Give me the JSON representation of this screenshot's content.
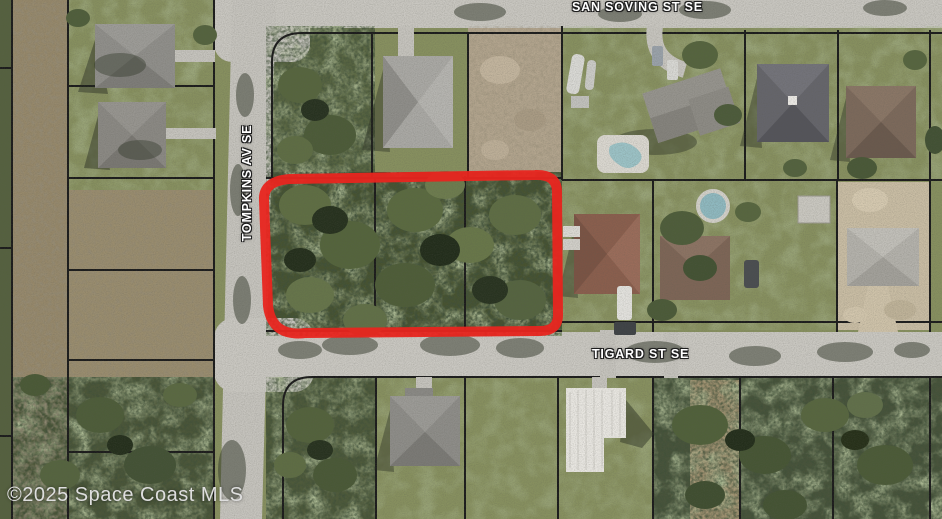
{
  "map": {
    "type": "aerial-satellite-parcel-map",
    "streets": [
      {
        "id": "san-soving",
        "label": "SAN SOVING ST SE",
        "orientation": "horizontal-top"
      },
      {
        "id": "tompkins",
        "label": "TOMPKINS AV SE",
        "orientation": "vertical-left"
      },
      {
        "id": "tigard",
        "label": "TIGARD ST SE",
        "orientation": "horizontal-middle"
      }
    ],
    "highlight": {
      "shape": "rounded-rectangle",
      "color": "#e8251f",
      "description": "Red outline around three adjoining wooded vacant lots at corner of Tompkins Av SE and Tigard St SE"
    },
    "watermark": "©2025 Space Coast MLS"
  },
  "colors": {
    "road": "#c9c7c1",
    "lawn": "#87905f",
    "woods": "#46522f",
    "scrub": "#97896c",
    "dirt_lot": "#b4a68f",
    "sand": "#c9bda4",
    "parcel_line": "#1b1b1b",
    "label_text": "#ffffff",
    "watermark_text": "#dedede",
    "highlight_red": "#e8251f",
    "pool_water": "#9cc3c7"
  }
}
